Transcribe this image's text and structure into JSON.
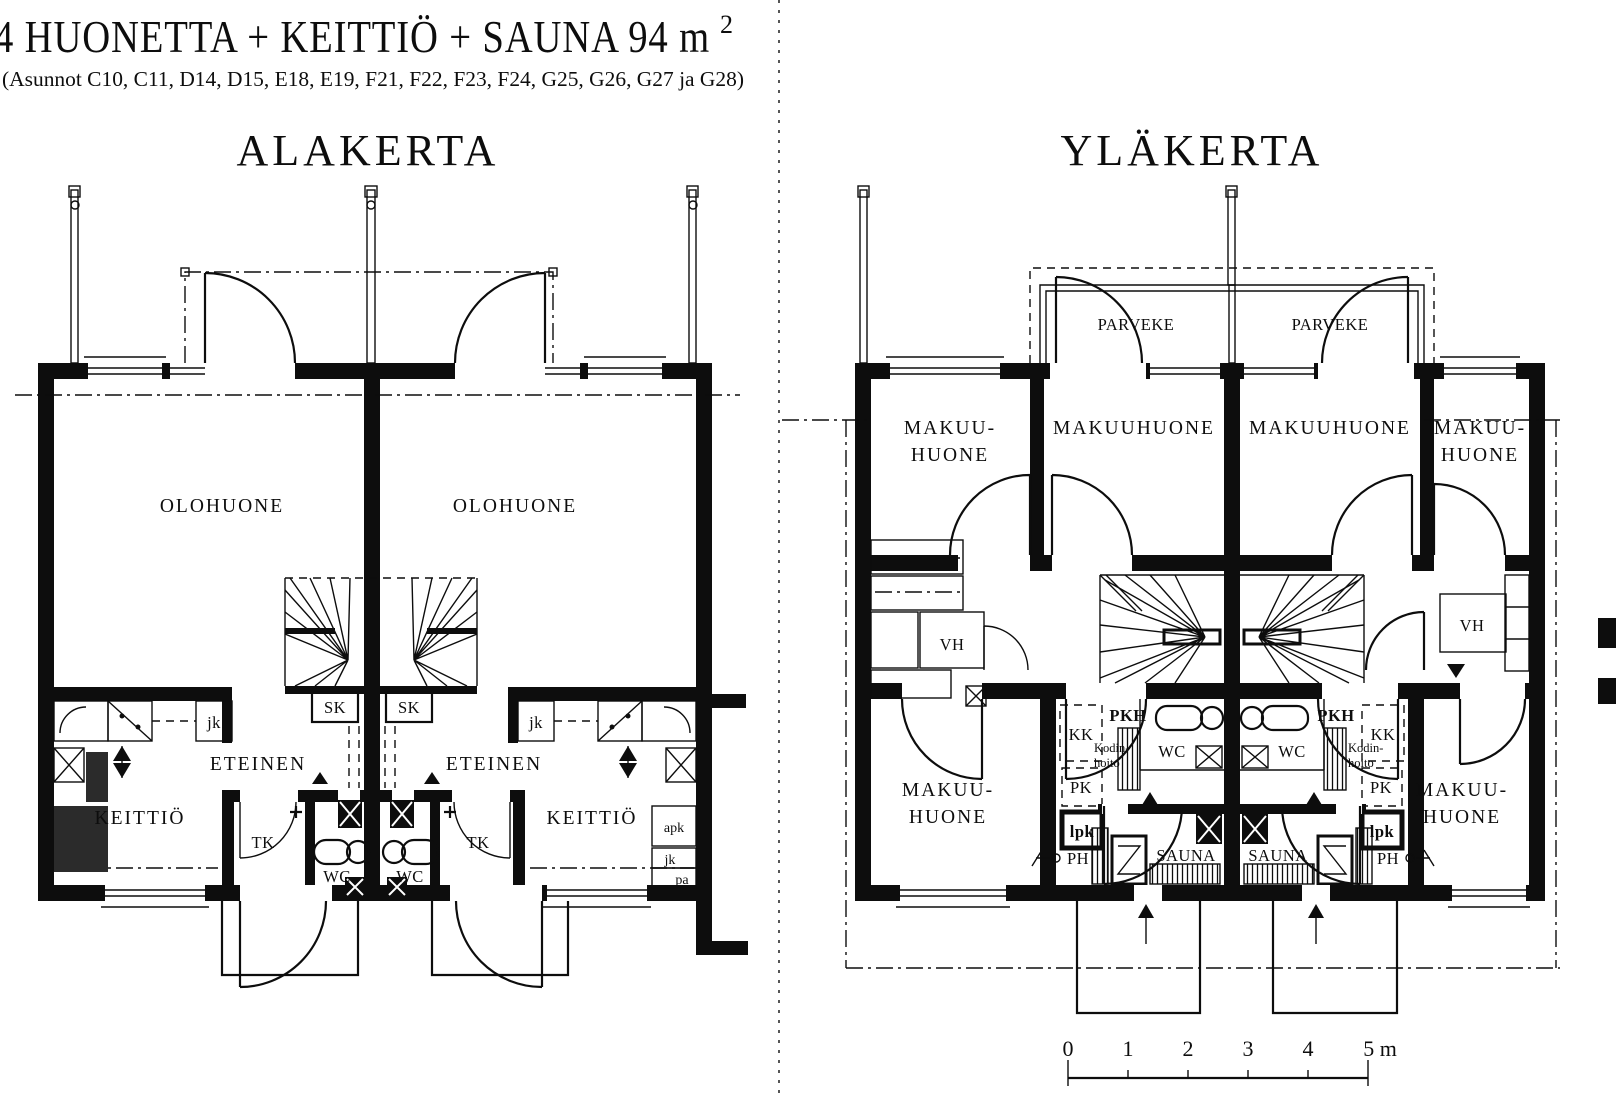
{
  "header": {
    "title_main": "4 HUONETTA + KEITTIÖ + SAUNA 94 m",
    "title_sup": "2",
    "subtitle": "(Asunnot C10, C11, D14, D15, E18, E19, F21, F22, F23, F24, G25, G26, G27 ja G28)"
  },
  "alakerta": {
    "title": "ALAKERTA",
    "labels": {
      "olohuone_l": "OLOHUONE",
      "olohuone_r": "OLOHUONE",
      "eteinen_l": "ETEINEN",
      "eteinen_r": "ETEINEN",
      "keittio_l": "KEITTIÖ",
      "keittio_r": "KEITTIÖ",
      "sk_l": "SK",
      "sk_r": "SK",
      "jk_l": "jk",
      "jk_r": "jk",
      "tk_l": "TK",
      "tk_r": "TK",
      "wc_l": "WC",
      "wc_r": "WC",
      "apk": "apk",
      "jk2": "jk",
      "pa": "pa"
    }
  },
  "ylakerta": {
    "title": "YLÄKERTA",
    "labels": {
      "parveke_l": "PARVEKE",
      "parveke_r": "PARVEKE",
      "makuu_tl1": "MAKUU-",
      "makuu_tl2": "HUONE",
      "makuuhuone_l": "MAKUUHUONE",
      "makuuhuone_r": "MAKUUHUONE",
      "makuu_tr1": "MAKUU-",
      "makuu_tr2": "HUONE",
      "vh_l": "VH",
      "vh_r": "VH",
      "kk_l": "KK",
      "kk_r": "KK",
      "pkh_l": "PKH",
      "pkh_r": "PKH",
      "kodin_l1": "Kodin-",
      "kodin_l2": "hoito",
      "kodin_r1": "Kodin-",
      "kodin_r2": "hoito",
      "wc_l": "WC",
      "wc_r": "WC",
      "pk_l": "PK",
      "pk_r": "PK",
      "lpk_l": "lpk",
      "lpk_r": "lpk",
      "ph_l": "PH",
      "ph_r": "PH",
      "sauna_l": "SAUNA",
      "sauna_r": "SAUNA",
      "makuu_bl1": "MAKUU-",
      "makuu_bl2": "HUONE",
      "makuu_br1": "MAKUU-",
      "makuu_br2": "HUONE"
    }
  },
  "scale_bar": {
    "t0": "0",
    "t1": "1",
    "t2": "2",
    "t3": "3",
    "t4": "4",
    "t5": "5 m"
  }
}
